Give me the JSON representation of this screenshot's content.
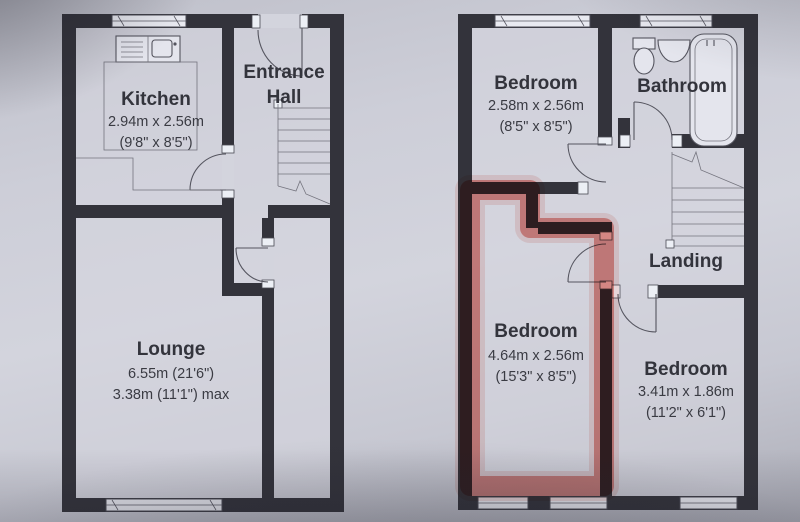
{
  "document": {
    "type": "estate-agent-floorplan-photo",
    "colors": {
      "highlight": "#d84438",
      "wall": "#33333b",
      "paper": "#cdced8",
      "text": "#33343c"
    },
    "icons": {
      "bath": "bathtub-symbol",
      "toilet": "toilet-symbol",
      "sink": "sink-symbol",
      "stairs": "staircase-symbol",
      "door": "door-arc-symbol",
      "window": "window-symbol"
    },
    "floors": {
      "ground": {
        "kitchen": {
          "name": "Kitchen",
          "dim_metric": "2.94m x 2.56m",
          "dim_imperial": "(9'8\" x 8'5\")"
        },
        "entrance_hall": {
          "name_line1": "Entrance",
          "name_line2": "Hall"
        },
        "lounge": {
          "name": "Lounge",
          "dim_metric": "6.55m (21'6\")",
          "dim_imperial": "3.38m (11'1\") max"
        }
      },
      "first": {
        "bedroom_front": {
          "name": "Bedroom",
          "dim_metric": "2.58m x 2.56m",
          "dim_imperial": "(8'5\" x 8'5\")"
        },
        "bathroom": {
          "name": "Bathroom"
        },
        "landing": {
          "name": "Landing"
        },
        "bedroom_highlighted": {
          "name": "Bedroom",
          "dim_metric": "4.64m x 2.56m",
          "dim_imperial": "(15'3\" x 8'5\")"
        },
        "bedroom_rear": {
          "name": "Bedroom",
          "dim_metric": "3.41m x 1.86m",
          "dim_imperial": "(11'2\" x 6'1\")"
        }
      }
    }
  }
}
